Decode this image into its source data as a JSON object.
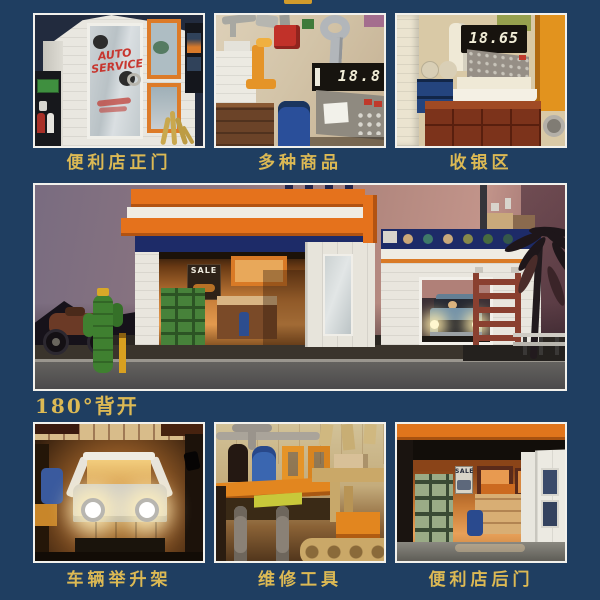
{
  "colors": {
    "page_background": "#1f3e61",
    "caption_gold": "#dcb954",
    "divider_gold": "#d29b2b",
    "card_border": "#f2f1ec",
    "brand_orange": "#e5721c",
    "brand_navy_band": "#1d2b68"
  },
  "gallery": {
    "top_row": [
      {
        "caption": "便利店正门"
      },
      {
        "caption": "多种商品"
      },
      {
        "caption": "收银区"
      }
    ],
    "feature": {
      "caption": "180°背开"
    },
    "bottom_row": [
      {
        "caption": "车辆举升架"
      },
      {
        "caption": "维修工具"
      },
      {
        "caption": "便利店后门"
      }
    ]
  },
  "scene_text": {
    "storefront_window_sign": "AUTO SERVICE",
    "goods_scale_display": "18.8",
    "register_display": "18.65",
    "interior_sale_sign": "SALE",
    "backdoor_sale_poster": "SALE"
  }
}
